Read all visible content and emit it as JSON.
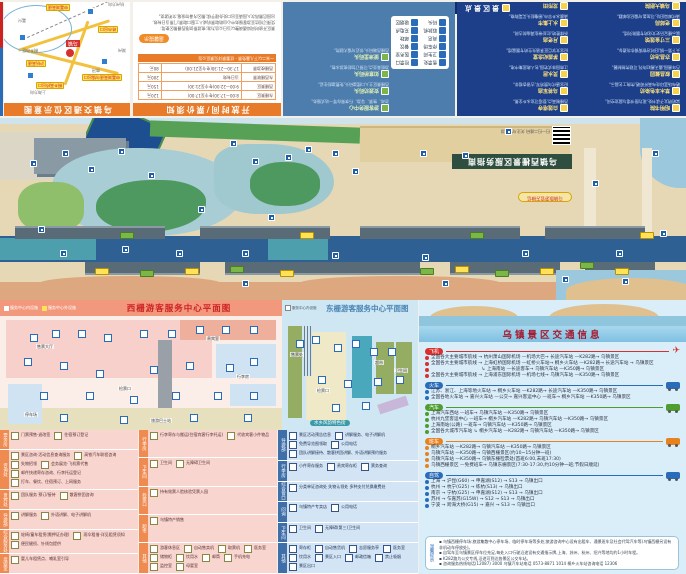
{
  "panel_location": {
    "title": "乌镇交通区位示意图",
    "center_label": "乌镇",
    "chips": [
      "申嘉湖高速乌镇出口",
      "桐乡高桥出口",
      "沪杭高速",
      "练市出口",
      "申嘉湖高速"
    ],
    "cities": [
      "湖州",
      "南浔",
      "桐乡市区",
      "嘉兴",
      "杭州方向",
      "上海方向"
    ]
  },
  "panel_hours": {
    "title": "开放时间/票价须知",
    "col_headers": [
      "景区",
      "开放时间",
      "票价"
    ],
    "rows": [
      {
        "name": "东栅景区",
        "time": "8:00—17:30(冬令至17:00)",
        "price": "120元"
      },
      {
        "name": "西栅景区",
        "time": "9:00—22:00(冬令至21:30)",
        "price": "150元"
      },
      {
        "name": "东西栅联票",
        "time": "当日有效",
        "price": "200元"
      },
      {
        "name": "西栅夜游票",
        "time": "17:30—21:30(冬令至21:00)",
        "price": "80元"
      }
    ],
    "highlight": "一米二以下儿童免票 · 优惠票详见景区公告",
    "tip_label": "温馨提示",
    "notice_label": "游览须知",
    "note_lines": [
      "景区开放时间如遇调整以当日公告为准;夜游票仅限西栅景区使用;",
      "凭预订短信至游客服务中心自助取票机或人工窗口取票;门票当日有效,",
      "出园后需再次入园请至出口处办理手续;景区内请勿吸烟,文明游览。"
    ]
  },
  "panel_facilities": {
    "legend": [
      [
        "售票处",
        "检票口"
      ],
      [
        "卫生间",
        "医务室"
      ],
      [
        "停车场",
        "餐饮"
      ],
      [
        "商店",
        "邮政"
      ],
      [
        "取款机",
        "充电点"
      ],
      [
        "码头",
        "吸烟区"
      ]
    ],
    "entries": [
      {
        "name": "游客服务中心",
        "desc": "咨询、售票、导游、行李寄存等一站式服务。"
      },
      {
        "name": "安渡坊码头",
        "desc": "西栅景区主入口摆渡码头,免费渡船往返。"
      },
      {
        "name": "如意桥码头",
        "desc": "游船乘坐点,可预订包船夜游水巷。"
      },
      {
        "name": "望津里码头",
        "desc": "西栅西端码头,邻近乌镇大剧院。"
      }
    ]
  },
  "panel_spots": {
    "title": "景区景点",
    "left": [
      {
        "name": "昭明书院",
        "desc": "梁昭明太子读书处,现为图书馆与展览空间。"
      },
      {
        "name": "草木本色染坊",
        "desc": "晒布场蓝印花布高杆晾晒,传统工艺展示。"
      },
      {
        "name": "叙昌酱园",
        "desc": "百年酱园,露天酱缸阵列,可观传统制酱。"
      },
      {
        "name": "亦昌冶坊",
        "desc": "天下第一锅,旧时冶铁铸锅作坊遗存。"
      },
      {
        "name": "三寸金莲馆",
        "desc": "展示缠足历史文化的专题陈列馆。"
      },
      {
        "name": "老邮局",
        "desc": "清代邮局旧址,可加盖乌镇纪念邮戳。"
      },
      {
        "name": "乌镇大剧院",
        "desc": "并蒂莲造型,乌镇戏剧节主场馆。"
      },
      {
        "name": "木心美术馆",
        "desc": "收藏陈列木心先生绘画与文学手稿。"
      }
    ],
    "right": [
      {
        "name": "白莲塔寺",
        "desc": "西栅制高点,登塔可览水乡全景。"
      },
      {
        "name": "乌将军庙",
        "desc": "纪念唐代乌赞将军,古银杏相伴。"
      },
      {
        "name": "灵水居",
        "desc": "江南园林式宅园,名人故居集中地。"
      },
      {
        "name": "茅盾纪念堂",
        "desc": "纪念文学巨匠茅盾先生的专题展馆。"
      },
      {
        "name": "月老庙",
        "desc": "祈缘胜地,红丝带挂满庙前古树。"
      },
      {
        "name": "水上集市",
        "desc": "清晨水乡早市,摇橹船头买菜购物。"
      },
      {
        "name": "龙形田",
        "desc": "巨型龙形稻田景观,四季色彩不同。"
      }
    ]
  },
  "map": {
    "banner": "乌镇西栅景区服务指南",
    "qr_tip": "扫一扫二维码 关注乌镇旅游",
    "wechat_pill": "乌镇旅游官方微信",
    "markers": [
      [
        30,
        42
      ],
      [
        62,
        32
      ],
      [
        88,
        48
      ],
      [
        118,
        30
      ],
      [
        148,
        54
      ],
      [
        230,
        22
      ],
      [
        252,
        40
      ],
      [
        285,
        36
      ],
      [
        305,
        28
      ],
      [
        332,
        32
      ],
      [
        352,
        50
      ],
      [
        420,
        32
      ],
      [
        462,
        34
      ],
      [
        505,
        10
      ],
      [
        60,
        132
      ],
      [
        122,
        128
      ],
      [
        176,
        132
      ],
      [
        242,
        132
      ],
      [
        332,
        134
      ],
      [
        422,
        136
      ],
      [
        522,
        132
      ],
      [
        616,
        132
      ],
      [
        660,
        112
      ],
      [
        592,
        62
      ],
      [
        652,
        32
      ],
      [
        38,
        108
      ],
      [
        242,
        162
      ],
      [
        442,
        162
      ],
      [
        562,
        158
      ],
      [
        622,
        160
      ],
      [
        198,
        88
      ],
      [
        268,
        96
      ]
    ],
    "tags": [
      [
        95,
        150,
        "y"
      ],
      [
        140,
        152,
        "g"
      ],
      [
        185,
        150,
        "y"
      ],
      [
        230,
        148,
        "g"
      ],
      [
        280,
        152,
        "y"
      ],
      [
        420,
        150,
        "g"
      ],
      [
        455,
        148,
        "y"
      ],
      [
        495,
        152,
        "g"
      ],
      [
        540,
        150,
        "y"
      ],
      [
        580,
        144,
        "g"
      ],
      [
        615,
        150,
        "y"
      ],
      [
        120,
        114,
        "g"
      ],
      [
        300,
        114,
        "y"
      ],
      [
        470,
        114,
        "g"
      ],
      [
        640,
        114,
        "y"
      ]
    ]
  },
  "west_plan": {
    "title": "西栅游客服务中心平面图",
    "legend_in": "服务中心内设施",
    "legend_out": "服务中心外设施",
    "chips": [
      [
        30,
        34
      ],
      [
        52,
        30
      ],
      [
        78,
        30
      ],
      [
        104,
        34
      ],
      [
        140,
        30
      ],
      [
        168,
        30
      ],
      [
        196,
        26
      ],
      [
        222,
        26
      ],
      [
        250,
        26
      ],
      [
        24,
        58
      ],
      [
        60,
        62
      ],
      [
        96,
        70
      ],
      [
        150,
        66
      ],
      [
        186,
        62
      ],
      [
        226,
        64
      ],
      [
        250,
        58
      ],
      [
        40,
        92
      ],
      [
        86,
        92
      ],
      [
        130,
        96
      ],
      [
        172,
        92
      ],
      [
        214,
        92
      ],
      [
        250,
        92
      ],
      [
        60,
        114
      ],
      [
        120,
        116
      ],
      [
        190,
        114
      ],
      [
        244,
        114
      ]
    ],
    "tags": [
      {
        "x": 36,
        "y": 44,
        "t": "售票大厅"
      },
      {
        "x": 118,
        "y": 86,
        "t": "检票口"
      },
      {
        "x": 206,
        "y": 36,
        "t": "贵宾室"
      },
      {
        "x": 236,
        "y": 74,
        "t": "行李房"
      },
      {
        "x": 24,
        "y": 112,
        "t": "停车场"
      },
      {
        "x": 150,
        "y": 118,
        "t": "旅游巴士站"
      }
    ]
  },
  "east_plan": {
    "title": "东栅游客服务中心平面图",
    "legend_in": "服务中心内设施",
    "legend_out": "服务中心外设施",
    "bottom_label": "水乡风韵特色街",
    "chips": [
      [
        14,
        40
      ],
      [
        30,
        36
      ],
      [
        52,
        44
      ],
      [
        70,
        40
      ],
      [
        88,
        48
      ],
      [
        106,
        48
      ],
      [
        36,
        76
      ],
      [
        62,
        80
      ],
      [
        92,
        78
      ],
      [
        114,
        76
      ],
      [
        50,
        104
      ],
      [
        80,
        102
      ]
    ],
    "tags": [
      {
        "x": 8,
        "y": 52,
        "t": "售票处"
      },
      {
        "x": 34,
        "y": 88,
        "t": "检票口"
      },
      {
        "x": 92,
        "y": 60,
        "t": "超市"
      },
      {
        "x": 112,
        "y": 68,
        "t": "卫生间"
      }
    ]
  },
  "legend_pink": {
    "col1": [
      {
        "h": "票务房",
        "items": [
          "门票预售·退改签",
          "住宿预订登记"
        ]
      },
      {
        "h": "咨询处",
        "items": [
          "景区咨询·活动信息查询服务",
          "高铁汽车联程咨询",
          "失物招领",
          "会务展览·飞机票代售",
          "邮件快递寄存咨询、行李托运登记",
          "打车、餐饮、住宿预订、上网服务"
        ]
      },
      {
        "h": "贵宾处",
        "items": [
          "团队服务 预订/接待",
          "散客拼团咨询"
        ]
      },
      {
        "h": "导游部",
        "items": [
          "讲解服务",
          "外语讲解、电子讲解机"
        ]
      },
      {
        "h": "综合服务处",
        "items": [
          "轮椅/童车租赁(需押证办理)",
          "雨伞租借·详见租赁须知",
          "便民缝纫、针线包提供"
        ]
      },
      {
        "h": "母婴室",
        "items": [
          "婴儿车租赁点、哺乳室引导"
        ]
      }
    ],
    "col2": [
      {
        "h": "行李房",
        "items": [
          "行李寄存与搬运(住宿宾客行李托运)",
          "代收宾客小件物品"
        ]
      },
      {
        "h": "卫生间",
        "items": [
          "卫生间",
          "无障碍卫生间"
        ]
      },
      {
        "h": "检票口",
        "items": [
          "持有效票人脸核验凭票入园"
        ]
      },
      {
        "h": "超市",
        "items": [
          "乌镇特产销售"
        ]
      },
      {
        "h": "其他",
        "items": [
          "游客休息区",
          "自动售卖机",
          "取票机",
          "医务室",
          "储物柜",
          "饮用水",
          "邮筒",
          "手机充电",
          "监控室",
          "母婴室"
        ]
      }
    ]
  },
  "legend_blue": {
    "rows": [
      {
        "h": "导游部",
        "items": [
          "景区活动预告信息",
          "讲解服务、电子讲解机",
          "免费导览图领取",
          "公用电话",
          "团队讲解接待、散客拼团讲解、外语讲解预约服务"
        ]
      },
      {
        "h": "行李房",
        "items": [
          "小件寄存服务",
          "贵宾寄存柜",
          "票务查询"
        ]
      },
      {
        "h": "综合窗口",
        "items": [
          "分类单证咨询处 失物认领处 多种支付兑换缴费处"
        ]
      },
      {
        "h": "问询",
        "items": [
          "乌镇特产专卖店",
          "公用电话"
        ]
      },
      {
        "h": "卫生间",
        "items": [
          "卫生间",
          "无障碍(第三)卫生间"
        ]
      },
      {
        "h": "其他",
        "items": [
          "寄存柜",
          "自动售货机",
          "志愿服务亭",
          "医务室",
          "饮用水",
          "景区入口",
          "邮政信箱",
          "禁止吸烟",
          "景区出口"
        ]
      }
    ]
  },
  "traffic": {
    "title": "乌镇景区交通信息",
    "sections": [
      {
        "label": "飞机",
        "color": "#d7302e",
        "type": "plane",
        "routes": [
          "全国各大主要城市航线 → 杭州萧山国际机场 —机场大巴→ 长途汽车站 —K282路→ 乌镇景区",
          "全国各大主要城市航线 → 上海虹桥国际机场 —虹桥火车站→ 桐乡火车站 —K282路→ 长途汽车站 → 乌镇景区",
          "　　　　　　　　　　　↳ 上海南站 —长途客车→ 乌镇汽车站 —K350路→ 乌镇景区",
          "全国各大主要城市航线 → 上海浦东国际机场 —机场七线→ 乌镇汽车站 —K350路→ 乌镇景区"
        ]
      },
      {
        "label": "火车",
        "color": "#2b6cb8",
        "type": "train",
        "routes": [
          "江苏、浙江、上海等地火车站 → 桐乡火车站 —K282路→ 长途汽车站 —K350路→ 乌镇景区",
          "全国各地火车站 → 嘉兴火车站 —公交→ 嘉兴客运中心 —班车→ 桐乡汽车站 —K350路→ 乌镇景区"
        ]
      },
      {
        "label": "汽车",
        "color": "#4f9d2f",
        "type": "bus",
        "routes": [
          "上海汽车西站 —班车→ 乌镇汽车站 —K350路→ 乌镇景区",
          "杭州九堡客运中心 —班车→ 桐乡汽车站 —K282路→ 乌镇汽车站 —K350路→ 乌镇景区",
          "上海南站(公路) —班车→ 乌镇汽车站 —K350路→ 乌镇景区",
          "全国各大城市汽车站 ↳ 桐乡汽车站 —K282路→ 乌镇汽车站 —K350路→ 乌镇景区"
        ]
      },
      {
        "label": "班车",
        "color": "#e8821e",
        "type": "shuttle",
        "routes": [
          "桐乡汽车站 —K282路→ 乌镇汽车站 —K350路→ 乌镇景区",
          "乌镇汽车站 —K350路→ 乌镇西栅景区(约10~15分钟一班)",
          "乌镇汽车站 —K350路→ 乌镇东栅检票处(首班6:00,末班17:30)",
          "乌镇西栅景区 —免费班车→ 乌镇东栅景区(7:30-17:30,约10分钟一班;节假日顺延)"
        ]
      },
      {
        "label": "自驾",
        "color": "#2b6cb8",
        "type": "car",
        "routes": [
          "上海 → 沪昆(G60) → 申嘉湖(S12) → S13 → 乌镇出口",
          "杭州 → 杭宁(G25) → 练杭(S13) → 乌镇出口",
          "南京 → 宁杭(G25) → 申嘉湖(S12) → S13 → 乌镇出口",
          "苏州 → 乍嘉苏(G15W) → S12 → S13 → 乌镇出口",
          "宁波 → 跨海大桥(G15) → 嘉兴 → S13 → 乌镇出口"
        ]
      }
    ],
    "tips_label": "温馨提示",
    "tips": [
      "乌镇西栅停车场:旅游集散中心停车场、临时停车场等多处;旅游咨询中心设有出租车、通景班车及社会代驾汽车等(乌镇西栅另设有非机动车停放处)。",
      "自驾车至乌镇景区停车位充足,每处入口行驶沿途设有交通指示牌,上海、苏州、杭州、绍兴等地均约1小时车程。",
      "K282路为公交专线,沿途可到达各景区公交车站。",
      "咨询服务热线电话(12087) 3000  乌镇汽车站电话 0573-8871 1014  桐乡火车站咨询电话 12306"
    ]
  }
}
